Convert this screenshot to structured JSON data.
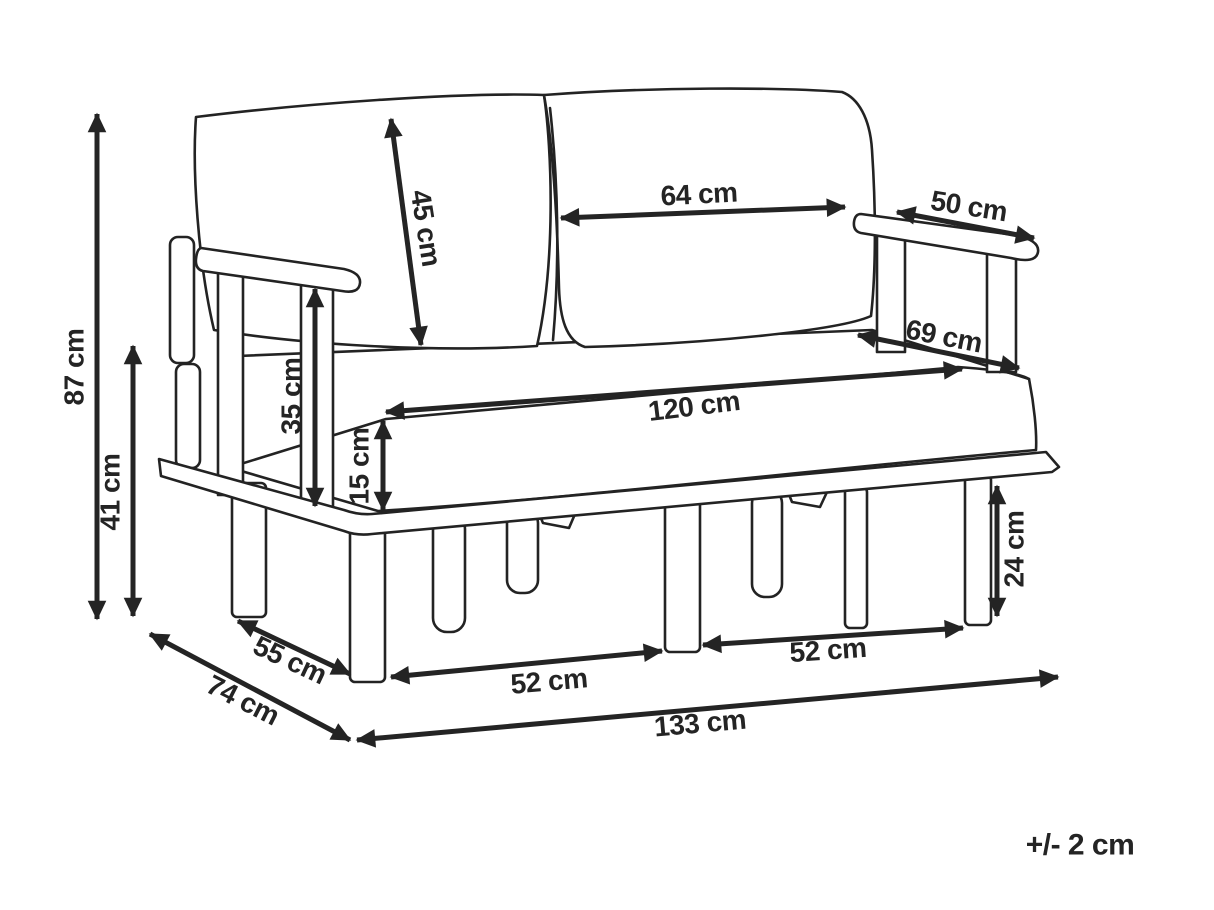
{
  "diagram_title": "sofa-dimension-diagram",
  "units": "cm",
  "dimensions": {
    "overall_height": "87 cm",
    "base_frame_height": "41 cm",
    "back_cushion_height": "45 cm",
    "back_cushion_width": "64 cm",
    "armrest_length": "50 cm",
    "seat_depth": "69 cm",
    "seat_width": "120 cm",
    "armrest_height": "35 cm",
    "seat_cushion_thickness": "15 cm",
    "leg_height": "24 cm",
    "side_leg_spacing": "55 cm",
    "overall_depth": "74 cm",
    "front_leg_spacing_left": "52 cm",
    "front_leg_spacing_right": "52 cm",
    "overall_width": "133 cm"
  },
  "tolerance_note": "+/- 2 cm"
}
